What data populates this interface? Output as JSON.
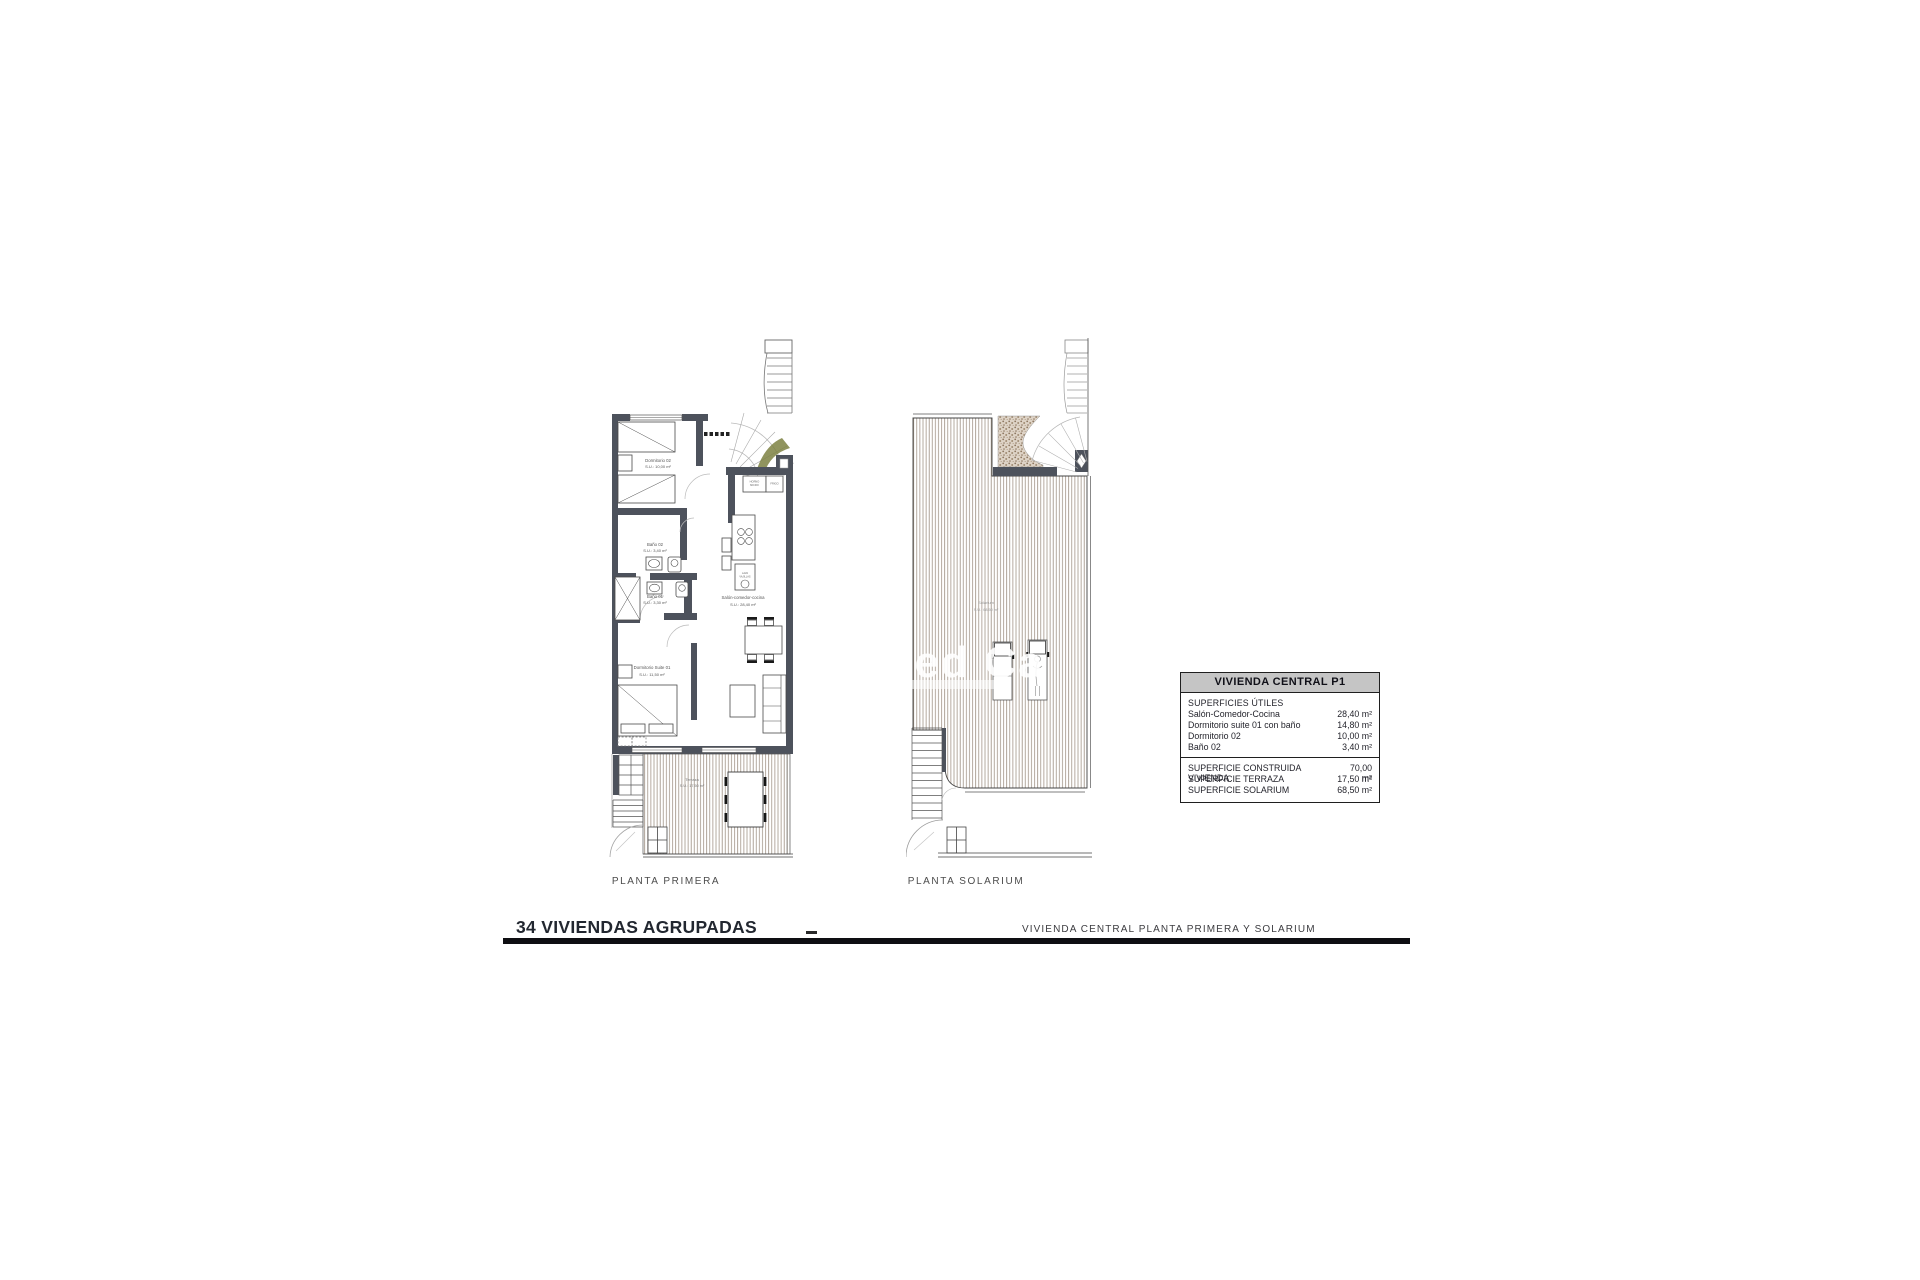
{
  "sheet": {
    "project_title": "34 VIVIENDAS AGRUPADAS",
    "sheet_subtitle": "VIVIENDA CENTRAL PLANTA PRIMERA Y SOLARIUM",
    "watermark": "Med Ca"
  },
  "first_floor": {
    "caption": "PLANTA PRIMERA",
    "dormitorio02_name": "Dormitorio 02",
    "dormitorio02_area": "S.U.: 10,00 m²",
    "bano02_name": "Baño 02",
    "bano02_area": "S.U.: 3,40 m²",
    "bano01_name": "Baño 01",
    "bano01_area": "S.U.: 3,30 m²",
    "salon_name": "Salón-comedor-cocina",
    "salon_area": "S.U.: 28,40 m²",
    "suite_name": "Dormitorio Suite 01",
    "suite_area": "S.U.: 11,50 m²",
    "terraza_name": "Terraza",
    "terraza_area": "S.U.: 17,50 m²",
    "cab_oven_line1": "HORNO",
    "cab_oven_line2": "MICRO",
    "cab_fridge": "FRIGO",
    "sink_line1": "LAVA",
    "sink_line2": "VAJILLAS"
  },
  "solarium": {
    "caption": "PLANTA SOLARIUM",
    "label_name": "Solarium",
    "label_area": "S.U.: 68,50 m²"
  },
  "summary_table": {
    "title": "VIVIENDA CENTRAL P1",
    "section": "SUPERFICIES ÚTILES",
    "rows": [
      {
        "label": "Salón-Comedor-Cocina",
        "value": "28,40 m²"
      },
      {
        "label": "Dormitorio suite 01 con baño",
        "value": "14,80 m²"
      },
      {
        "label": "Dormitorio 02",
        "value": "10,00 m²"
      },
      {
        "label": "Baño 02",
        "value": "3,40 m²"
      }
    ],
    "totals": [
      {
        "label": "SUPERFICIE CONSTRUIDA VIVIENDA",
        "value": "70,00 m²"
      },
      {
        "label": "SUPERFICIE TERRAZA",
        "value": "17,50 m²"
      },
      {
        "label": "SUPERFICIE SOLARIUM",
        "value": "68,50 m²"
      }
    ]
  },
  "colors": {
    "wall": "#4d525c",
    "deck_line": "#9a8c7e",
    "accent_green": "#7d8142",
    "table_header_bg": "#c5c5c5"
  }
}
